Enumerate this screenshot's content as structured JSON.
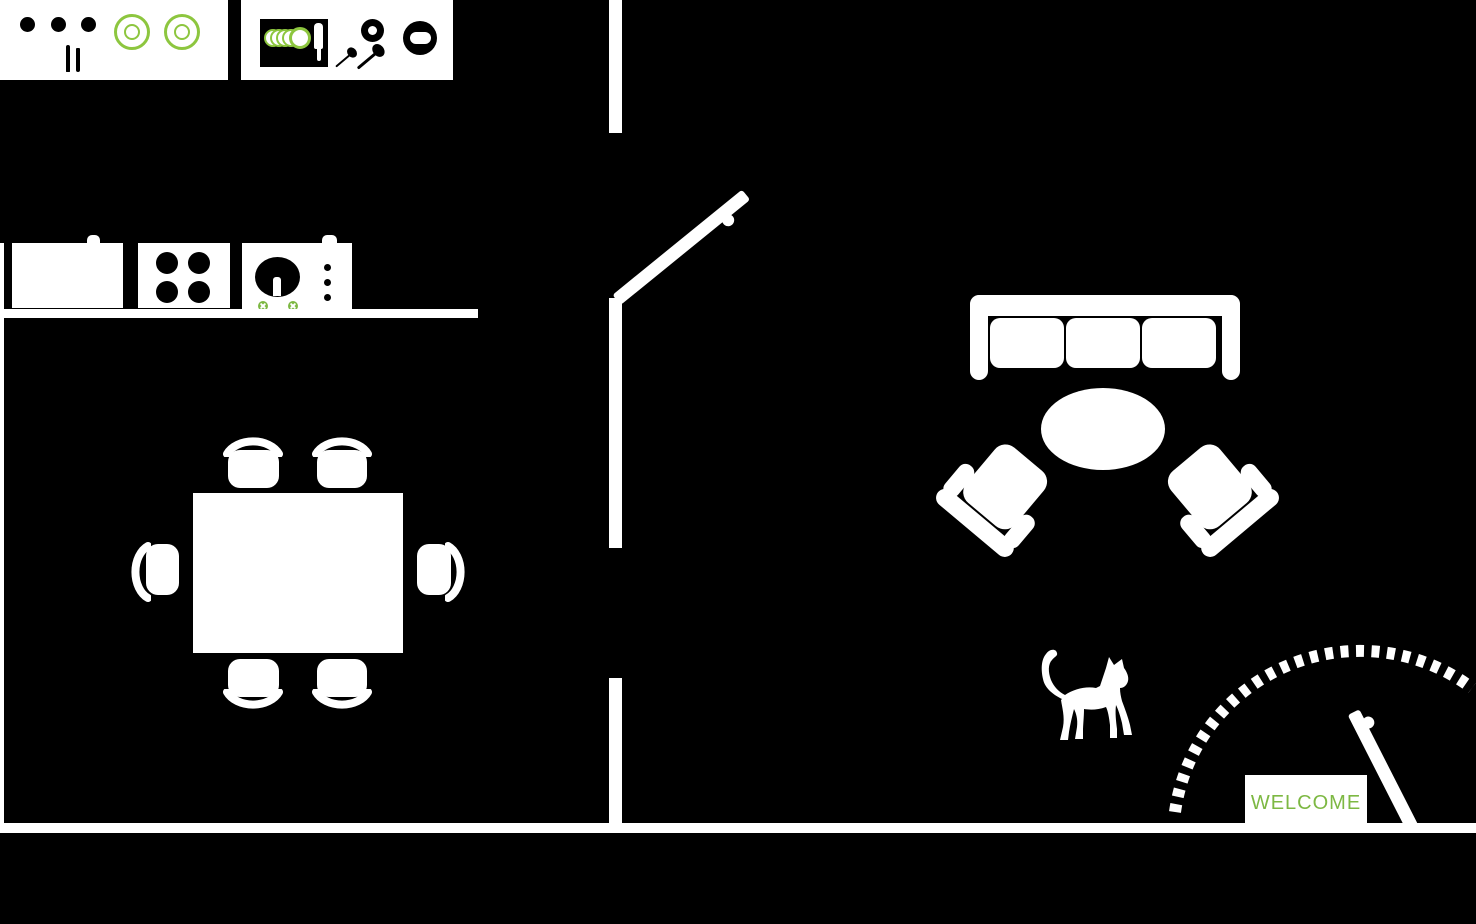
{
  "title": "apartment floor plan illustration",
  "colors": {
    "background": "#000000",
    "furniture": "#ffffff",
    "accent_green": "#7db843",
    "plate_green": "#8dc63f"
  },
  "kitchen": {
    "upper_counter_left": {
      "knob_dots": 3,
      "plates": 2,
      "utensils": [
        "knife",
        "fork"
      ]
    },
    "upper_counter_right": {
      "dish_rack_plates": 5,
      "knife": 1,
      "spoons": 2,
      "small_bowl": 1,
      "pot": 1
    },
    "appliance_run": [
      "sink-cabinet",
      "stove",
      "washing-machine"
    ],
    "stove_burners": 4,
    "washing_machine": {
      "door_screws": 2,
      "buttons": 3
    }
  },
  "dining": {
    "table": "rectangular",
    "chairs": 6
  },
  "living": {
    "sofa_cushions": 3,
    "coffee_table": "oval",
    "armchairs": 2,
    "pet": "cat"
  },
  "entrance": {
    "mat_label": "WELCOME",
    "door_state": "open",
    "swing_arc": "dashed"
  },
  "walls": {
    "interior_doors": 2,
    "bottom_wall": true,
    "left_wall": true,
    "center_wall_segments": 3
  }
}
